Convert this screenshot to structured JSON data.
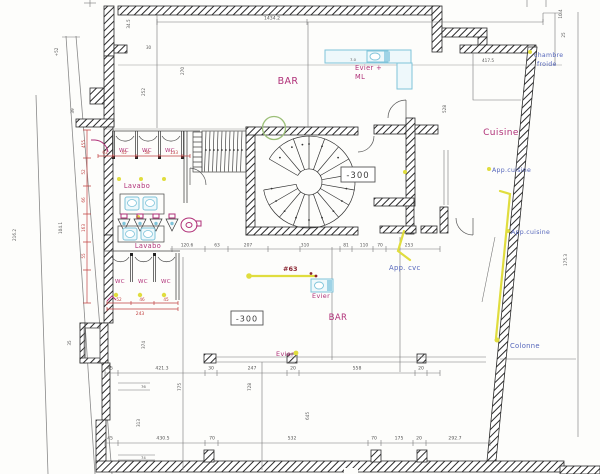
{
  "drawing": {
    "kind": "scanned architectural basement floor plan",
    "colors": {
      "wall_hatch": "#2b2b2b",
      "magenta": "#b03078",
      "red_dim": "#c04040",
      "dark_red": "#8a2430",
      "blue": "#5566bb",
      "cyan": "#7fc4da",
      "yellow": "#e0dd3e",
      "green": "#9bbf77",
      "dim_text": "#555555"
    }
  },
  "level_boxes": {
    "upper": "-300",
    "lower": "-300"
  },
  "rooms": {
    "bar_upper": "BAR",
    "bar_lower": "BAR",
    "cuisine": "Cuisine",
    "lavabo_upper": "Lavabo",
    "lavabo_lower": "Lavabo",
    "chambre_froide": [
      "chambre",
      "froide"
    ]
  },
  "fixtures": {
    "evier_ml": [
      "Evier +",
      "ML"
    ],
    "evier_mid": "Evier",
    "evier_lower": "Evier",
    "wc_upper": [
      "WC",
      "WC",
      "WC"
    ],
    "wc_lower": [
      "WC",
      "WC",
      "WC"
    ]
  },
  "annotations": {
    "app_cvc": "App. cvc",
    "app_cuisine_upper": "App.cuisine",
    "app_cuisine_lower": "App.cuisine",
    "colonne": "Colonne",
    "ref": "#63"
  },
  "dimensions": {
    "top": "1434.2",
    "mid_row": [
      "120.6",
      "63",
      "207",
      "310",
      "81",
      "110",
      "70",
      "253"
    ],
    "row_lower": [
      "45",
      "421.3",
      "30",
      "247",
      "20",
      "558",
      "20"
    ],
    "row_bottom": [
      "45",
      "430.5",
      "70",
      "532",
      "70",
      "175",
      "20",
      "292.7"
    ],
    "red_upper": [
      "63",
      "45",
      "58",
      "133"
    ],
    "red_lower": [
      "52",
      "46",
      "45"
    ],
    "red_lower_total": "243",
    "red_left": [
      "455",
      "52",
      "66",
      "163",
      "55"
    ],
    "rotated": [
      "216.2",
      "104.1",
      "34.5",
      "+52",
      "39",
      "252",
      "270",
      "775",
      "728",
      "313",
      "374",
      "35",
      "645",
      "528",
      "10.4",
      "25",
      "175.3"
    ],
    "small": [
      "417.5",
      "30",
      "7.0",
      "76",
      "74"
    ]
  }
}
